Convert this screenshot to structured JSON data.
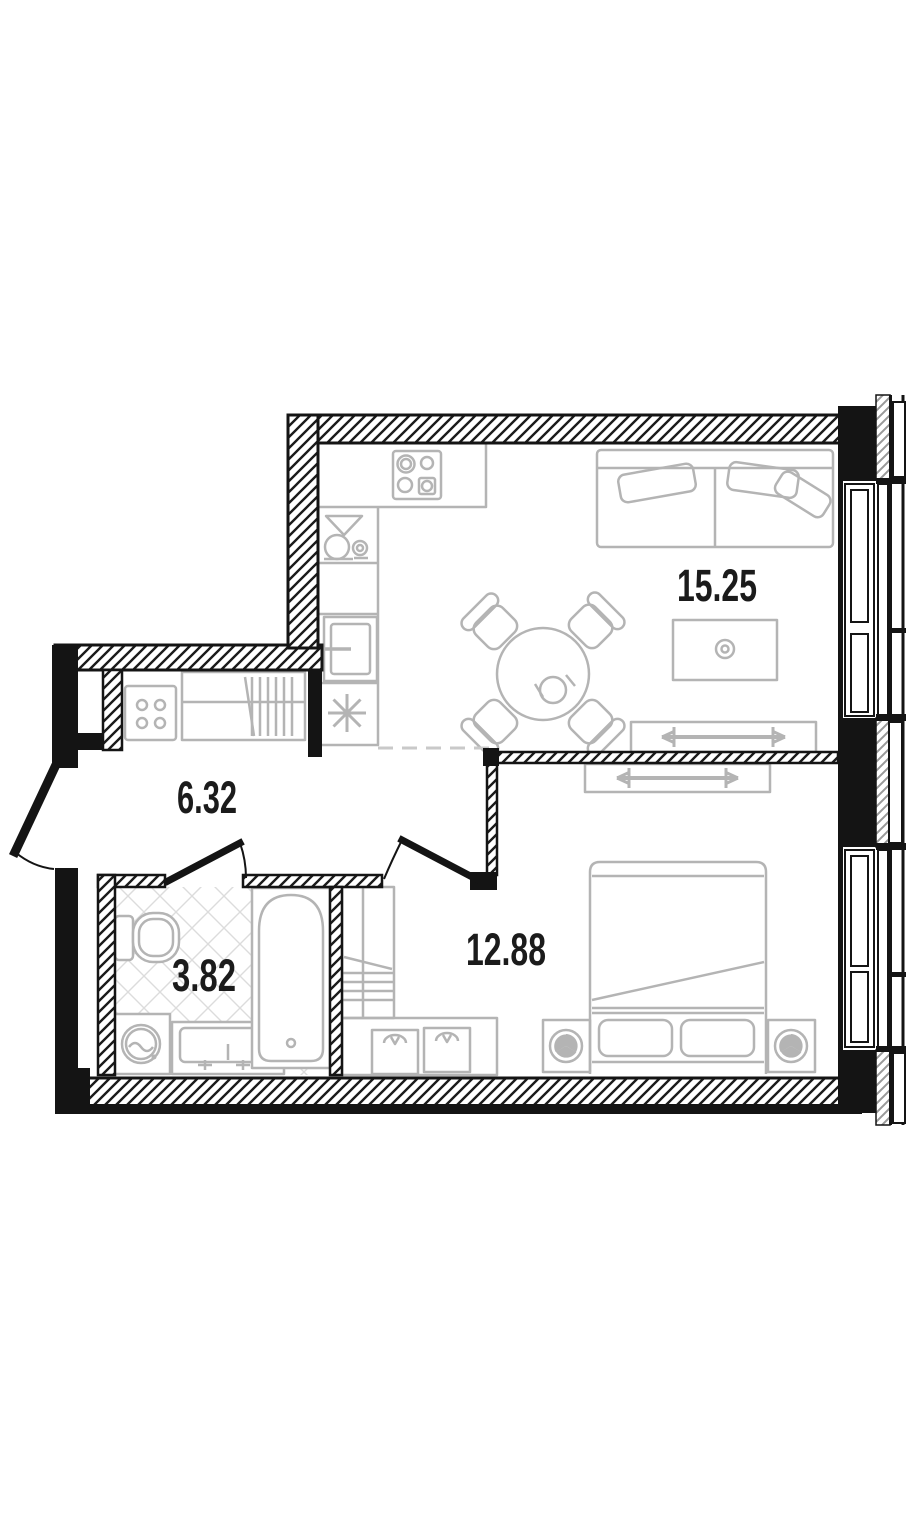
{
  "document": {
    "type": "apartment-floor-plan",
    "title": "1-room apartment plan"
  },
  "rooms": [
    {
      "name": "kitchen-living-room",
      "area": "15.25"
    },
    {
      "name": "hallway",
      "area": "6.32"
    },
    {
      "name": "bathroom",
      "area": "3.82"
    },
    {
      "name": "bedroom",
      "area": "12.88"
    }
  ],
  "colors": {
    "wall": "#141414",
    "furniture": "#b4b4b4",
    "label": "#1b1b1b",
    "tile_line": "#dcdcdc",
    "zone_dash": "#c9c9c9",
    "window_hatch": "#999999",
    "background": "#ffffff"
  },
  "furniture_icons": [
    "cooktop-4-burner-icon",
    "kitchen-sink-icon",
    "oven-icon",
    "refrigerator-snowflake-icon",
    "dining-table-4-chairs-icon",
    "sofa-icon",
    "coffee-table-icon",
    "sliding-wardrobe-living-icon",
    "sliding-wardrobe-bedroom-icon",
    "hallway-cabinet-icon",
    "hallway-open-wardrobe-icon",
    "double-bed-icon",
    "nightstand-fan-icon-left",
    "nightstand-fan-icon-right",
    "dresser-baskets-icon",
    "shelving-wardrobe-icon",
    "toilet-icon",
    "washing-machine-icon",
    "vanity-sink-icon",
    "bathtub-icon",
    "entrance-door-icon",
    "bathroom-door-icon",
    "bedroom-door-icon",
    "window-living-icon",
    "window-bedroom-icon",
    "kitchen-zone-dashed-line"
  ]
}
